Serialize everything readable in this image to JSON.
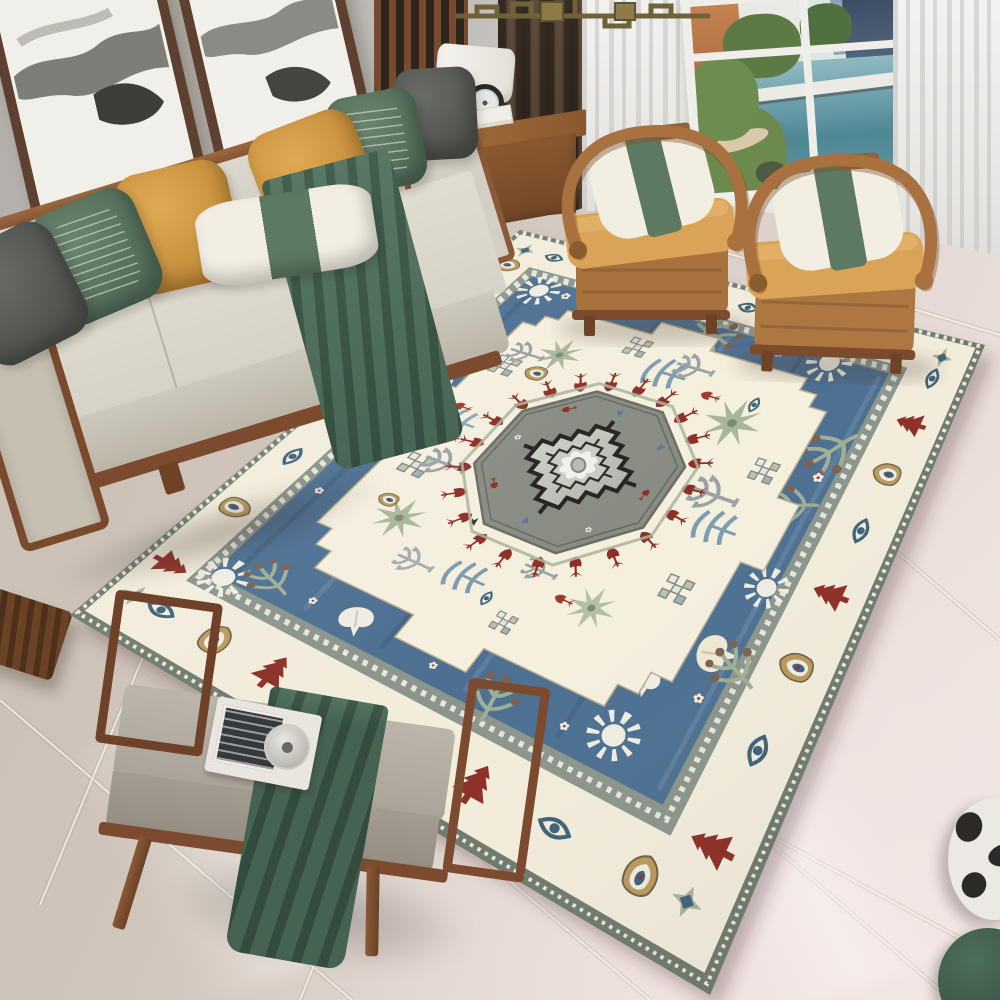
{
  "scene": {
    "type": "photograph",
    "subject": "Bohemian medallion area rug in a modern Chinese-style living room",
    "objects": [
      "ink-wash wall art",
      "wood-frame sofa with pillows",
      "two horseshoe armchairs",
      "window with city and water view",
      "sheer curtains",
      "wood slat screen",
      "brass chandelier",
      "side cabinet with lamp",
      "upholstered bench with tray",
      "marble tile floor",
      "ceramic stool",
      "green pouf"
    ]
  },
  "palette": {
    "wall": "#bdb9b4",
    "windowFrame": "#efeeea",
    "sheer": "#ececea",
    "curtainDark": "#4a3c30",
    "brass": "#6f6238",
    "frameWood": "#5d4030",
    "sofaWood": "#8a5a38",
    "sofaCushion": "#d8d4ca",
    "pillowGray": "#54574f",
    "pillowGreen": "#5d7561",
    "pillowMustard": "#d09b44",
    "pillowWhite": "#f0ece1",
    "chairBand": "#5e7961",
    "throwGreen": "#49684f",
    "chairWood": "#a9713f",
    "chairCushion": "#d8a355",
    "chairPillow": "#f2eee2",
    "benchWood": "#7a4a2c",
    "benchCushion": "#b6afa5",
    "blanket": "#3f5d4b",
    "floorWarm": "#cfc5bb",
    "floorPink": "#f1e7e3",
    "stool": "#ece9e4",
    "pouf": "#3e5b4a"
  },
  "rug": {
    "corners": {
      "L": [
        70,
        615
      ],
      "T": [
        520,
        230
      ],
      "R": [
        985,
        345
      ],
      "B": [
        710,
        995
      ]
    },
    "colors": {
      "edge": "#6f7b6d",
      "edgeDash": "#e9e6d9",
      "border": "#f2ecdb",
      "borderLine": "#8f948b",
      "guard": "#8b958b",
      "guardDash": "#f0eee4",
      "blue": "#4d7092",
      "blueLight": "#7c99b4",
      "blueDark": "#3d5f80",
      "panel": "#f5efde",
      "panelLine": "#b9ac8f",
      "octagon": "#898c83",
      "octagonEdge": "#6a6e65",
      "octagonHalo": "#a9b39f",
      "medallionA": "#d4d7cd",
      "medallionB": "#a9ada3",
      "outline": "#26241f",
      "flower": "#f0f1ea",
      "red": "#8e2f26",
      "tan": "#b99a5c",
      "blueMotif": "#3f6378",
      "white": "#efece2",
      "sage": "#a8b79c",
      "steel": "#7e9cb0",
      "gray": "#9aa2a6",
      "dark": "#3a3c36",
      "brown": "#7a6253"
    },
    "bands": {
      "edge": 0.013,
      "borderIn": 0.105,
      "guardIn": 0.128,
      "centerline": 0.058,
      "guardMid": 0.1165
    },
    "panel": {
      "ua": 0.195,
      "ub": 0.81,
      "va": 0.2,
      "vb": 0.81,
      "cut": 0.09,
      "steps": 3,
      "bumpW": 0.06,
      "bumpD": 0.035
    },
    "octagon": {
      "ru": 0.16,
      "rv": 0.168
    },
    "medallion": {
      "hu": 0.1,
      "hv": 0.105,
      "steps": 5,
      "innerHu": 0.058,
      "innerHv": 0.062,
      "innerSteps": 4
    },
    "tulipRing": {
      "count": 22,
      "ru": 0.185,
      "rv": 0.192,
      "size": 12
    },
    "borderCounts": [
      8,
      6,
      8,
      8
    ],
    "borderTypes": [
      "tree",
      "boteh",
      "eye"
    ],
    "blueMotifs": [
      {
        "t": "sun",
        "u": 0.13,
        "v": 0.15,
        "s": 24
      },
      {
        "t": "sun",
        "u": 0.84,
        "v": 0.17,
        "s": 19
      },
      {
        "t": "sun",
        "u": 0.86,
        "v": 0.77,
        "s": 22
      },
      {
        "t": "sun",
        "u": 0.17,
        "v": 0.78,
        "s": 27
      },
      {
        "t": "sun",
        "u": 0.42,
        "v": 0.86,
        "s": 22
      },
      {
        "t": "ginkgo",
        "u": 0.56,
        "v": 0.155,
        "s": 17,
        "r": 170,
        "c": "#efece2"
      },
      {
        "t": "ginkgo",
        "u": 0.155,
        "v": 0.38,
        "s": 19,
        "r": 60,
        "c": "#efece2"
      },
      {
        "t": "ginkgo",
        "u": 0.845,
        "v": 0.3,
        "s": 16,
        "r": -100,
        "c": "#e9e0c9"
      },
      {
        "t": "ginkgo",
        "u": 0.31,
        "v": 0.845,
        "s": 23,
        "r": -15,
        "c": "#efe9d2"
      },
      {
        "t": "ginkgo",
        "u": 0.24,
        "v": 0.78,
        "s": 17,
        "r": 75,
        "c": "#efece2"
      },
      {
        "t": "branch",
        "u": 0.155,
        "v": 0.22,
        "s": 22,
        "r": 20
      },
      {
        "t": "branch",
        "u": 0.145,
        "v": 0.62,
        "s": 25,
        "r": 85
      },
      {
        "t": "branch",
        "u": 0.68,
        "v": 0.85,
        "s": 26,
        "r": -55
      },
      {
        "t": "branch",
        "u": 0.85,
        "v": 0.55,
        "s": 22,
        "r": -160
      },
      {
        "t": "branch",
        "u": 0.3,
        "v": 0.875,
        "s": 25,
        "r": 25
      },
      {
        "t": "branch",
        "u": 0.56,
        "v": 0.84,
        "s": 22,
        "r": -20
      },
      {
        "t": "daisy",
        "u": 0.3,
        "v": 0.155,
        "s": 8
      },
      {
        "t": "daisy",
        "u": 0.5,
        "v": 0.15,
        "s": 8
      },
      {
        "t": "daisy",
        "u": 0.7,
        "v": 0.16,
        "s": 8
      },
      {
        "t": "daisy",
        "u": 0.845,
        "v": 0.23,
        "s": 8
      },
      {
        "t": "daisy",
        "u": 0.85,
        "v": 0.68,
        "s": 9
      },
      {
        "t": "daisy",
        "u": 0.62,
        "v": 0.85,
        "s": 10
      },
      {
        "t": "daisy",
        "u": 0.42,
        "v": 0.155,
        "s": 8
      },
      {
        "t": "daisy",
        "u": 0.155,
        "v": 0.3,
        "s": 8
      },
      {
        "t": "daisy",
        "u": 0.15,
        "v": 0.52,
        "s": 8
      },
      {
        "t": "daisy",
        "u": 0.155,
        "v": 0.72,
        "s": 9
      },
      {
        "t": "daisy",
        "u": 0.72,
        "v": 0.155,
        "s": 8
      },
      {
        "t": "daisy",
        "u": 0.25,
        "v": 0.85,
        "s": 10
      }
    ],
    "panelPlants": [
      {
        "t": "palm",
        "u": 0.31,
        "v": 0.31,
        "s": 25,
        "c": "#a8b79c"
      },
      {
        "t": "palm",
        "u": 0.67,
        "v": 0.68,
        "s": 28,
        "c": "#a8b79c"
      },
      {
        "t": "palm",
        "u": 0.3,
        "v": 0.66,
        "s": 24,
        "c": "#b3c0a6"
      },
      {
        "t": "palm",
        "u": 0.7,
        "v": 0.32,
        "s": 21,
        "c": "#a8b79c"
      },
      {
        "t": "wave",
        "u": 0.27,
        "v": 0.47,
        "s": 21,
        "c": "#7e9cb0"
      },
      {
        "t": "wave",
        "u": 0.73,
        "v": 0.52,
        "s": 21,
        "c": "#7e9cb0"
      },
      {
        "t": "wave",
        "u": 0.5,
        "v": 0.255,
        "s": 19,
        "c": "#8aa6b8"
      },
      {
        "t": "wave",
        "u": 0.48,
        "v": 0.75,
        "s": 22,
        "c": "#7e9cb0"
      },
      {
        "t": "checker",
        "u": 0.4,
        "v": 0.26,
        "s": 17
      },
      {
        "t": "checker",
        "u": 0.64,
        "v": 0.245,
        "s": 15
      },
      {
        "t": "checker",
        "u": 0.37,
        "v": 0.75,
        "s": 18
      },
      {
        "t": "checker",
        "u": 0.6,
        "v": 0.77,
        "s": 16
      },
      {
        "t": "checker",
        "u": 0.235,
        "v": 0.565,
        "s": 14
      },
      {
        "t": "checker",
        "u": 0.77,
        "v": 0.44,
        "s": 14
      },
      {
        "t": "gtree",
        "u": 0.42,
        "v": 0.3,
        "s": 21,
        "c": "#9aa2a6"
      },
      {
        "t": "gtree",
        "u": 0.53,
        "v": 0.72,
        "s": 24,
        "c": "#9aa2a6"
      },
      {
        "t": "gtree",
        "u": 0.26,
        "v": 0.385,
        "s": 19,
        "c": "#a5adb0"
      },
      {
        "t": "gtree",
        "u": 0.76,
        "v": 0.56,
        "s": 19,
        "c": "#9aa2a6"
      },
      {
        "t": "gtree",
        "u": 0.32,
        "v": 0.56,
        "s": 17,
        "c": "#9aa2a6"
      },
      {
        "t": "gtree",
        "u": 0.68,
        "v": 0.26,
        "s": 17,
        "c": "#9aa2a6"
      },
      {
        "t": "tulip",
        "u": 0.47,
        "v": 0.27,
        "s": 10,
        "c": "#9c3a2a"
      },
      {
        "t": "tulip",
        "u": 0.295,
        "v": 0.62,
        "s": 10,
        "c": "#9c3a2a"
      },
      {
        "t": "tulip",
        "u": 0.71,
        "v": 0.62,
        "s": 10,
        "c": "#9c3a2a"
      },
      {
        "t": "tulip",
        "u": 0.53,
        "v": 0.245,
        "s": 9,
        "c": "#9c3a2a"
      },
      {
        "t": "bird",
        "u": 0.415,
        "v": 0.45,
        "s": 9,
        "c": "#3a3c36"
      },
      {
        "t": "bird",
        "u": 0.59,
        "v": 0.41,
        "s": 9,
        "c": "#3a3c36"
      },
      {
        "t": "bird",
        "u": 0.5,
        "v": 0.585,
        "s": 9,
        "c": "#3a3c36"
      },
      {
        "t": "bird",
        "u": 0.35,
        "v": 0.42,
        "s": 8,
        "c": "#3a3c36"
      },
      {
        "t": "boteh",
        "u": 0.645,
        "v": 0.31,
        "s": 12
      },
      {
        "t": "boteh",
        "u": 0.33,
        "v": 0.27,
        "s": 11
      },
      {
        "t": "eye",
        "u": 0.255,
        "v": 0.52,
        "s": 11,
        "c": "#3f6378"
      },
      {
        "t": "eye",
        "u": 0.72,
        "v": 0.695,
        "s": 11,
        "c": "#3f6378"
      }
    ],
    "octagonDeco": [
      {
        "t": "bird",
        "a": 0,
        "r": 0.12,
        "s": 8,
        "c": "#53779b"
      },
      {
        "t": "bird",
        "a": 50,
        "r": 0.125,
        "s": 8,
        "c": "#53779b"
      },
      {
        "t": "tulip",
        "a": 95,
        "r": 0.12,
        "s": 7,
        "c": "#8e2f26"
      },
      {
        "t": "daisy",
        "a": 140,
        "r": 0.125,
        "s": 6,
        "c": "#e8e6da"
      },
      {
        "t": "bird",
        "a": 185,
        "r": 0.12,
        "s": 8,
        "c": "#53779b"
      },
      {
        "t": "tulip",
        "a": 230,
        "r": 0.125,
        "s": 7,
        "c": "#8e2f26"
      },
      {
        "t": "daisy",
        "a": 275,
        "r": 0.12,
        "s": 6,
        "c": "#e8e6da"
      },
      {
        "t": "tulip",
        "a": 320,
        "r": 0.125,
        "s": 7,
        "c": "#8e2f26"
      }
    ],
    "floorSeams": [
      [
        0,
        700,
        352,
        1000
      ],
      [
        190,
        610,
        650,
        1000
      ],
      [
        420,
        540,
        940,
        990
      ],
      [
        150,
        640,
        40,
        905
      ],
      [
        470,
        575,
        300,
        1000
      ],
      [
        800,
        500,
        640,
        880
      ],
      [
        700,
        245,
        1000,
        335
      ],
      [
        860,
        520,
        1000,
        640
      ],
      [
        760,
        830,
        1000,
        960
      ]
    ]
  }
}
